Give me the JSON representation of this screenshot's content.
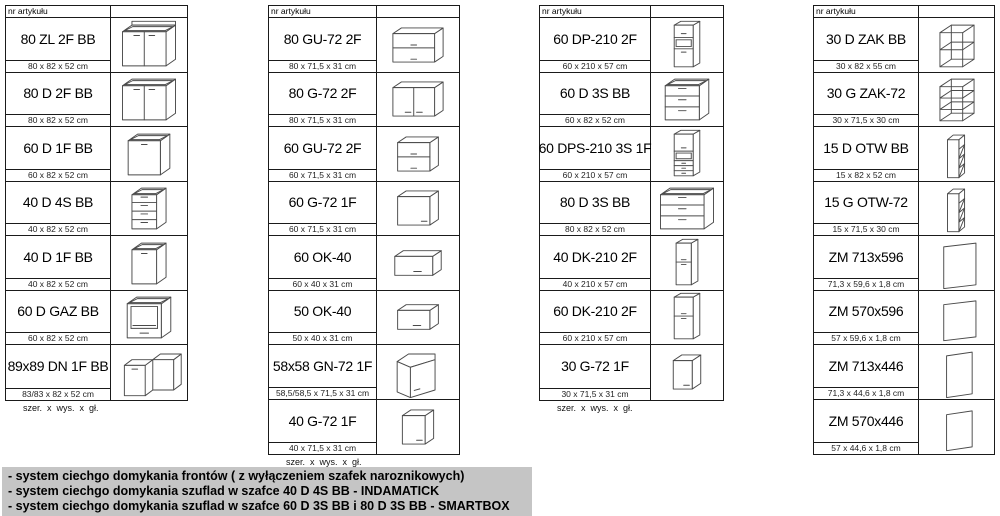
{
  "header_label": "nr artykułu",
  "size_legend": "szer.  x  wys.  x  gł.",
  "colors": {
    "table_border": "#1a1a1a",
    "drawing_stroke": "#4a4a4a",
    "notes_bg": "#c5c5c5",
    "dim_text": "#222222"
  },
  "tables": [
    {
      "name": "base-cabinets",
      "has_footer": true,
      "rows": [
        {
          "code": "80 ZL 2F BB",
          "dims": "80 x 82 x 52 cm",
          "drawing": "sink-base-2-door"
        },
        {
          "code": "80 D 2F BB",
          "dims": "80 x 82 x 52 cm",
          "drawing": "base-2-door-wide"
        },
        {
          "code": "60 D 1F BB",
          "dims": "60 x 82 x 52 cm",
          "drawing": "base-1-door"
        },
        {
          "code": "40 D 4S BB",
          "dims": "40 x 82 x 52 cm",
          "drawing": "base-4-drawers"
        },
        {
          "code": "40 D 1F BB",
          "dims": "40 x 82 x 52 cm",
          "drawing": "base-1-door-narrow"
        },
        {
          "code": "60 D GAZ BB",
          "dims": "60 x 82 x 52 cm",
          "drawing": "oven-housing"
        },
        {
          "code": "89x89 DN 1F BB",
          "dims": "83/83 x 82 x 52 cm",
          "drawing": "corner-base"
        }
      ]
    },
    {
      "name": "wall-cabinets",
      "has_footer": true,
      "rows": [
        {
          "code": "80 GU-72 2F",
          "dims": "80 x 71,5 x 31 cm",
          "drawing": "wall-2-flaps-wide"
        },
        {
          "code": "80 G-72 2F",
          "dims": "80 x 71,5 x 31 cm",
          "drawing": "wall-2-doors"
        },
        {
          "code": "60 GU-72 2F",
          "dims": "60 x 71,5 x 31 cm",
          "drawing": "wall-2-flaps"
        },
        {
          "code": "60 G-72 1F",
          "dims": "60 x 71,5 x 31 cm",
          "drawing": "wall-1-door"
        },
        {
          "code": "60 OK-40",
          "dims": "60 x 40 x 31 cm",
          "drawing": "wall-flap-wide"
        },
        {
          "code": "50 OK-40",
          "dims": "50 x 40 x 31 cm",
          "drawing": "wall-flap"
        },
        {
          "code": "58x58 GN-72 1F",
          "dims": "58,5/58,5 x 71,5 x 31 cm",
          "drawing": "corner-wall"
        },
        {
          "code": "40 G-72 1F",
          "dims": "40 x 71,5 x 31 cm",
          "drawing": "wall-1-door-narrow"
        }
      ]
    },
    {
      "name": "tall-and-drawer-cabinets",
      "has_footer": true,
      "rows": [
        {
          "code": "60 DP-210 2F",
          "dims": "60 x 210 x 57 cm",
          "drawing": "tall-oven-niche"
        },
        {
          "code": "60 D 3S BB",
          "dims": "60 x 82 x 52 cm",
          "drawing": "base-3-drawers"
        },
        {
          "code": "60 DPS-210 3S 1F",
          "dims": "60 x 210 x 57 cm",
          "drawing": "tall-niche-drawers"
        },
        {
          "code": "80 D 3S BB",
          "dims": "80 x 82 x 52 cm",
          "drawing": "base-3-drawers-wide"
        },
        {
          "code": "40 DK-210 2F",
          "dims": "40 x 210 x 57 cm",
          "drawing": "tall-2-doors-narrow"
        },
        {
          "code": "60 DK-210 2F",
          "dims": "60 x 210 x 57 cm",
          "drawing": "tall-2-doors"
        },
        {
          "code": "30 G-72 1F",
          "dims": "30 x 71,5 x 31 cm",
          "drawing": "wall-1-door-small"
        }
      ]
    },
    {
      "name": "open-units-and-panels",
      "has_footer": false,
      "rows": [
        {
          "code": "30 D ZAK BB",
          "dims": "30 x 82 x 55 cm",
          "drawing": "open-end-shelf-base"
        },
        {
          "code": "30 G ZAK-72",
          "dims": "30 x 71,5 x 30 cm",
          "drawing": "open-end-shelf-wall"
        },
        {
          "code": "15 D OTW BB",
          "dims": "15 x 82 x 52 cm",
          "drawing": "open-narrow-base"
        },
        {
          "code": "15 G OTW-72",
          "dims": "15 x 71,5 x 30 cm",
          "drawing": "open-narrow-wall"
        },
        {
          "code": "ZM 713x596",
          "dims": "71,3 x 59,6 x 1,8 cm",
          "drawing": "panel-large"
        },
        {
          "code": "ZM 570x596",
          "dims": "57 x 59,6 x 1,8 cm",
          "drawing": "panel-medium"
        },
        {
          "code": "ZM 713x446",
          "dims": "71,3 x 44,6 x 1,8 cm",
          "drawing": "panel-small"
        },
        {
          "code": "ZM 570x446",
          "dims": "57 x 44,6 x 1,8 cm",
          "drawing": "panel-xsmall"
        }
      ]
    }
  ],
  "notes": [
    "- system ciechgo domykania frontów ( z wyłączeniem szafek naroznikowych)",
    "- system ciechgo domykania szuflad w szafce 40 D 4S BB - INDAMATICK",
    "- system ciechgo domykania szuflad w szafce 60 D 3S BB i 80 D 3S BB - SMARTBOX"
  ]
}
